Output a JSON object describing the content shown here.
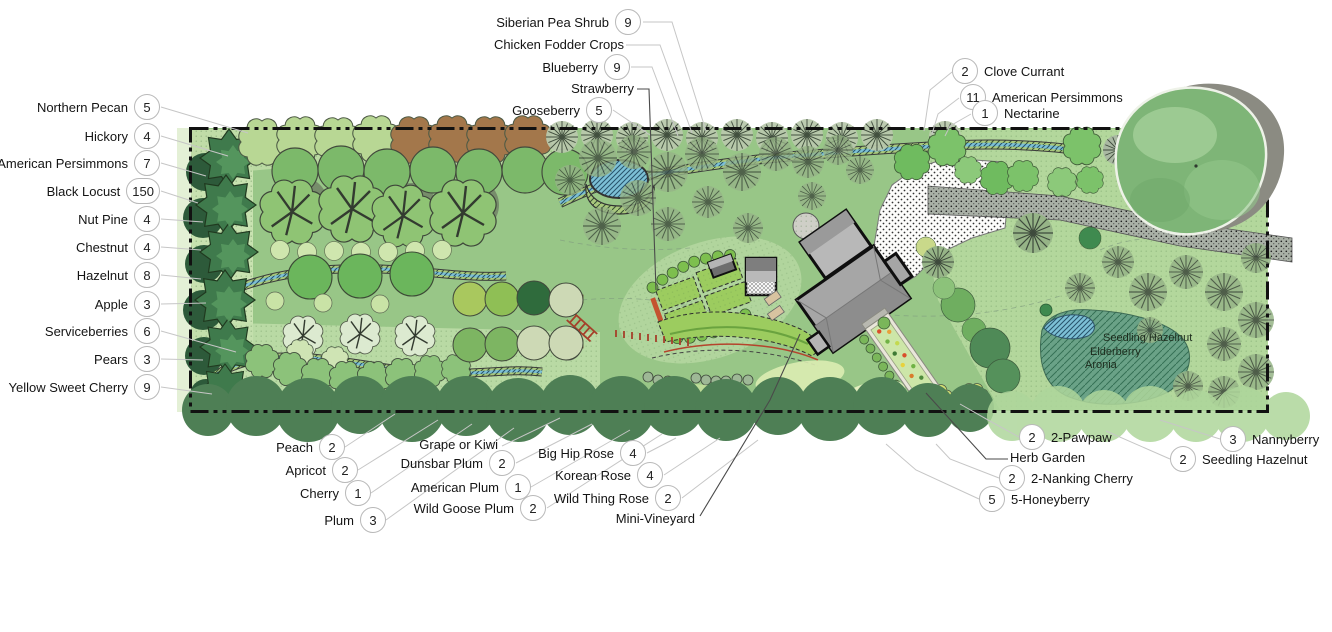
{
  "map": {
    "wetland_labels": [
      "Seedling Hazelnut",
      "Elderberry",
      "Aronia"
    ],
    "colors": {
      "lawn": "#98c687",
      "boundary": "#111111",
      "water": "#7cc0d6",
      "windbreak": "#4e7f55",
      "building": "#a6a6a6",
      "bed_green": "#9ccc5f",
      "accent_red": "#b5442c"
    }
  },
  "callouts": {
    "left": [
      {
        "label": "Northern Pecan",
        "count": "5"
      },
      {
        "label": "Hickory",
        "count": "4"
      },
      {
        "label": "American Persimmons",
        "count": "7"
      },
      {
        "label": "Black Locust",
        "count": "150"
      },
      {
        "label": "Nut Pine",
        "count": "4"
      },
      {
        "label": "Chestnut",
        "count": "4"
      },
      {
        "label": "Hazelnut",
        "count": "8"
      },
      {
        "label": "Apple",
        "count": "3"
      },
      {
        "label": "Serviceberries",
        "count": "6"
      },
      {
        "label": "Pears",
        "count": "3"
      },
      {
        "label": "Yellow Sweet Cherry",
        "count": "9"
      }
    ],
    "top": [
      {
        "label": "Siberian Pea Shrub",
        "count": "9"
      },
      {
        "label": "Chicken Fodder Crops"
      },
      {
        "label": "Blueberry",
        "count": "9"
      },
      {
        "label": "Strawberry"
      },
      {
        "label": "Gooseberry",
        "count": "5"
      }
    ],
    "top_right": [
      {
        "count": "2",
        "label": "Clove Currant"
      },
      {
        "count": "11",
        "label": "American Persimmons"
      },
      {
        "count": "1",
        "label": "Nectarine"
      }
    ],
    "bottom_left": [
      {
        "label": "Peach",
        "count": "2"
      },
      {
        "label": "Apricot",
        "count": "2"
      },
      {
        "label": "Cherry",
        "count": "1"
      },
      {
        "label": "Plum",
        "count": "3"
      }
    ],
    "bottom_mid": [
      {
        "label": "Grape or Kiwi"
      },
      {
        "label": "Dunsbar Plum",
        "count": "2"
      },
      {
        "label": "American Plum",
        "count": "1"
      },
      {
        "label": "Wild Goose Plum",
        "count": "2"
      }
    ],
    "bottom_roses": [
      {
        "label": "Big Hip Rose",
        "count": "4"
      },
      {
        "label": "Korean Rose",
        "count": "4"
      },
      {
        "label": "Wild Thing Rose",
        "count": "2"
      },
      {
        "label": "Mini-Vineyard"
      }
    ],
    "bottom_right": [
      {
        "count": "2",
        "label": "2-Pawpaw"
      },
      {
        "label": "Herb Garden"
      },
      {
        "count": "2",
        "label": "2-Nanking Cherry"
      },
      {
        "count": "5",
        "label": "5-Honeyberry"
      }
    ],
    "bottom_far_right": [
      {
        "count": "3",
        "label": "Nannyberry"
      },
      {
        "count": "2",
        "label": "Seedling Hazelnut"
      }
    ]
  }
}
